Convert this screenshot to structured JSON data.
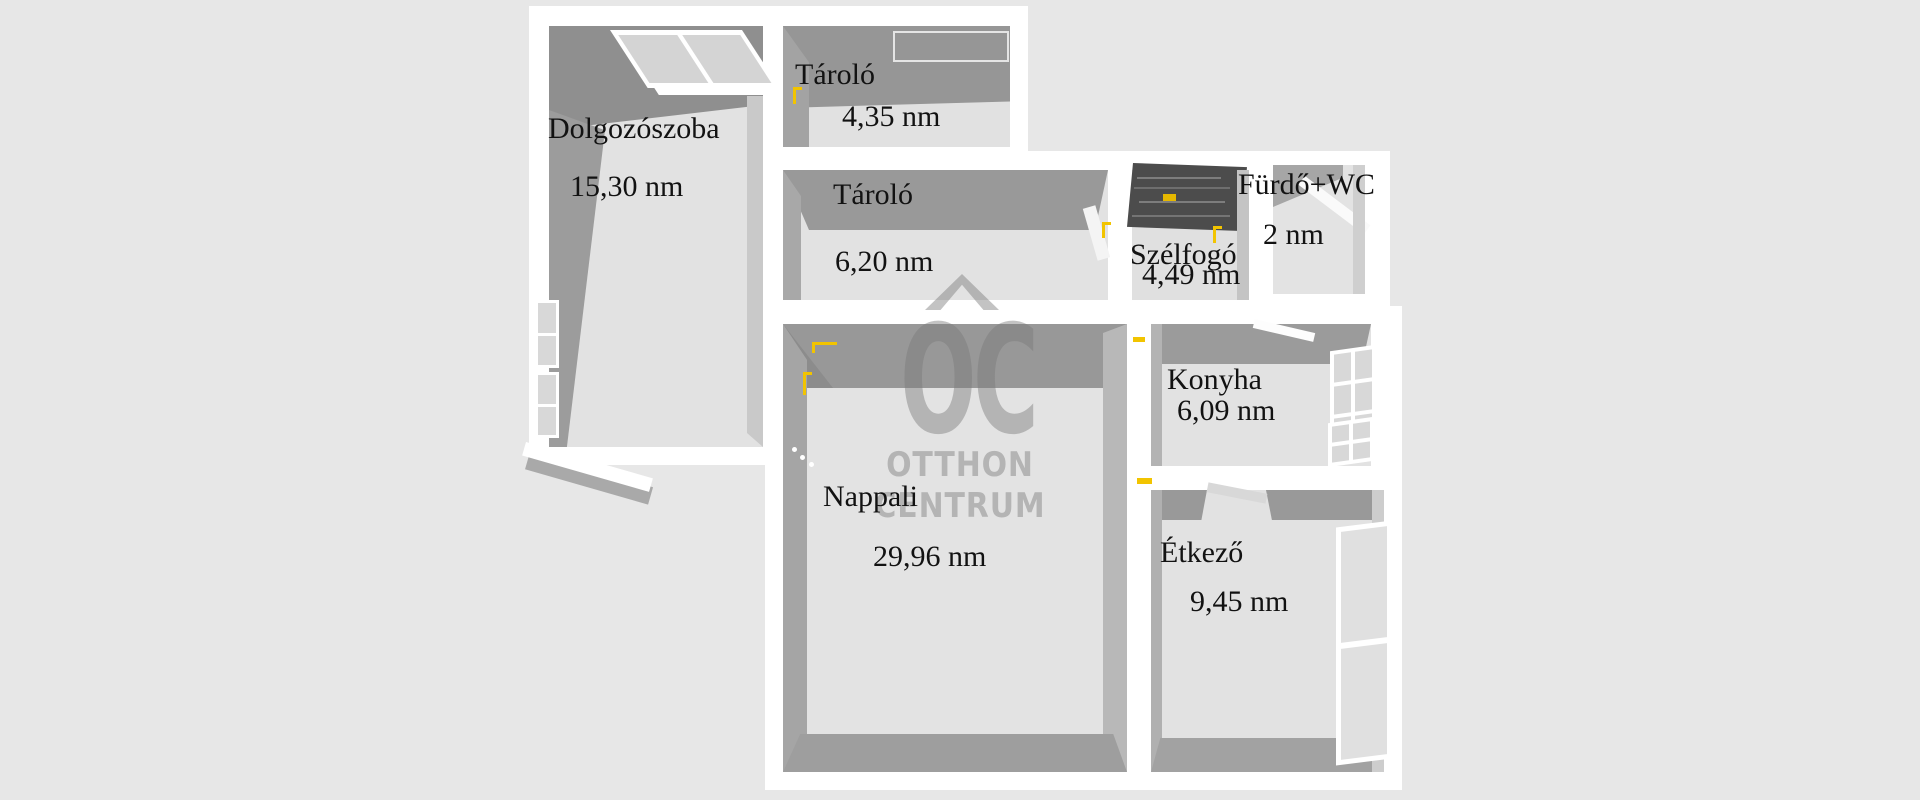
{
  "plan": {
    "kind": "3d-floorplan",
    "unit": "nm"
  },
  "watermark": {
    "logo": "OC",
    "line1": "OTTHON",
    "line2": "CENTRUM"
  },
  "rooms": [
    {
      "name": "Dolgozószoba",
      "area": "15,30 nm"
    },
    {
      "name": "Tároló",
      "area": "4,35 nm"
    },
    {
      "name": "Tároló",
      "area": "6,20 nm"
    },
    {
      "name": "Szélfogó",
      "area": "4,49 nm"
    },
    {
      "name": "Fürdő+WC",
      "area": "2 nm"
    },
    {
      "name": "Konyha",
      "area": "6,09 nm"
    },
    {
      "name": "Nappali",
      "area": "29,96 nm"
    },
    {
      "name": "Étkező",
      "area": "9,45 nm"
    }
  ],
  "colors": {
    "background": "#e7e7e7",
    "wall_white": "#ffffff",
    "wall_shadow_dark": "#9a9a9a",
    "floor": "#e2e2e2",
    "handle_accent": "#f2c400",
    "stairs_dark": "#4c4c4c",
    "watermark_gray": "#7a7a7a",
    "label_text": "#121212"
  }
}
